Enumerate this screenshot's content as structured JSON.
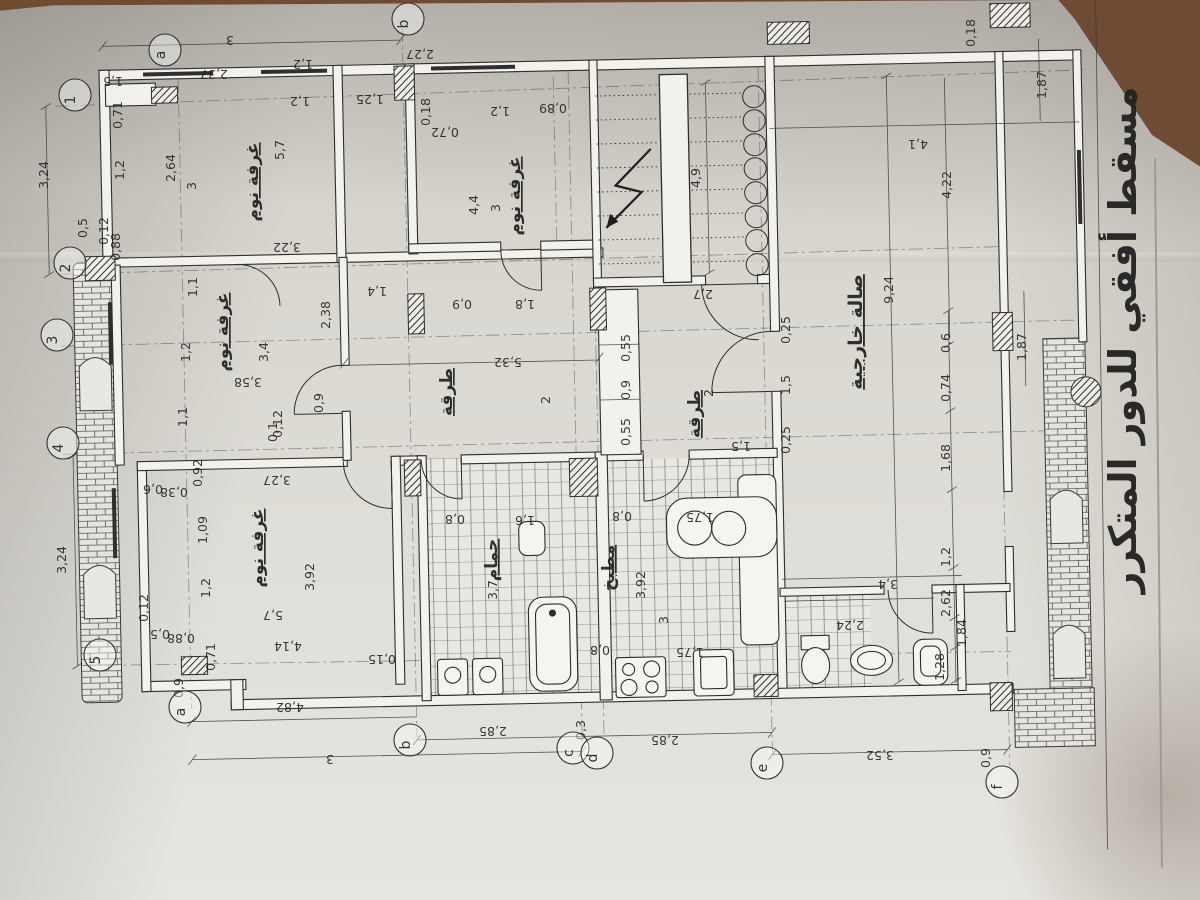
{
  "photo": {
    "background_color": "#6f4b34",
    "paper_color": "#d8d5cf",
    "ink_color": "#2e2e2e"
  },
  "title": {
    "text": "مسقط أفقي للدور المتكرر"
  },
  "plan": {
    "room_labels": [
      {
        "text": "غرفة نوم",
        "x": 258,
        "y": 182,
        "r": -90
      },
      {
        "text": "غرفة نوم",
        "x": 520,
        "y": 196,
        "r": -90
      },
      {
        "text": "غرفة نوم",
        "x": 228,
        "y": 332,
        "r": -90
      },
      {
        "text": "غرفة نوم",
        "x": 263,
        "y": 548,
        "r": -90
      },
      {
        "text": "طرقة",
        "x": 452,
        "y": 392,
        "r": -90
      },
      {
        "text": "طرقة",
        "x": 700,
        "y": 414,
        "r": -90
      },
      {
        "text": "صالة خارجية",
        "x": 862,
        "y": 332,
        "r": -90,
        "big": true
      },
      {
        "text": "حمام",
        "x": 497,
        "y": 560,
        "r": -90,
        "small": true
      },
      {
        "text": "مطبخ",
        "x": 614,
        "y": 568,
        "r": -90,
        "small": true
      }
    ],
    "dimension_labels": [
      {
        "t": "3",
        "x": 230,
        "y": 36,
        "r": 180
      },
      {
        "t": "1,5",
        "x": 113,
        "y": 77,
        "r": 180
      },
      {
        "t": "2,37",
        "x": 214,
        "y": 70,
        "r": 180
      },
      {
        "t": "1,2",
        "x": 303,
        "y": 60,
        "r": 180
      },
      {
        "t": "1,2",
        "x": 300,
        "y": 97,
        "r": 180
      },
      {
        "t": "1,25",
        "x": 370,
        "y": 95,
        "r": 180
      },
      {
        "t": "2,27",
        "x": 420,
        "y": 50,
        "r": 180
      },
      {
        "t": "0,18",
        "x": 430,
        "y": 112,
        "r": -90
      },
      {
        "t": "1,2",
        "x": 500,
        "y": 107,
        "r": 180
      },
      {
        "t": "0,89",
        "x": 553,
        "y": 104,
        "r": 180
      },
      {
        "t": "0,72",
        "x": 445,
        "y": 128,
        "r": 180
      },
      {
        "t": "0,18",
        "x": 975,
        "y": 33,
        "r": -90
      },
      {
        "t": "1,87",
        "x": 1046,
        "y": 85,
        "r": -90
      },
      {
        "t": "4,1",
        "x": 918,
        "y": 140,
        "r": 180
      },
      {
        "t": "4,22",
        "x": 951,
        "y": 185,
        "r": -90
      },
      {
        "t": "4,9",
        "x": 700,
        "y": 178,
        "r": -90
      },
      {
        "t": "2,7",
        "x": 703,
        "y": 290,
        "r": 180
      },
      {
        "t": "9,24",
        "x": 893,
        "y": 290,
        "r": -90
      },
      {
        "t": "2,64",
        "x": 175,
        "y": 168,
        "r": -90
      },
      {
        "t": "3",
        "x": 196,
        "y": 186,
        "r": -90
      },
      {
        "t": "5,7",
        "x": 284,
        "y": 150,
        "r": -90
      },
      {
        "t": "3,22",
        "x": 287,
        "y": 243,
        "r": 180
      },
      {
        "t": "4,4",
        "x": 478,
        "y": 205,
        "r": -90
      },
      {
        "t": "3",
        "x": 500,
        "y": 208,
        "r": -90
      },
      {
        "t": "1,8",
        "x": 525,
        "y": 300,
        "r": 180
      },
      {
        "t": "0,9",
        "x": 462,
        "y": 300,
        "r": 180
      },
      {
        "t": "1,4",
        "x": 377,
        "y": 287,
        "r": 180
      },
      {
        "t": "2,38",
        "x": 330,
        "y": 315,
        "r": -90
      },
      {
        "t": "3,4",
        "x": 268,
        "y": 352,
        "r": -90
      },
      {
        "t": "3,58",
        "x": 248,
        "y": 378,
        "r": 180
      },
      {
        "t": "1,1",
        "x": 197,
        "y": 287,
        "r": -90
      },
      {
        "t": "1,2",
        "x": 190,
        "y": 352,
        "r": -90
      },
      {
        "t": "1,1",
        "x": 187,
        "y": 417,
        "r": -90
      },
      {
        "t": "0,12",
        "x": 282,
        "y": 424,
        "r": -90
      },
      {
        "t": "0,9",
        "x": 323,
        "y": 403,
        "r": -90
      },
      {
        "t": "5,32",
        "x": 508,
        "y": 358,
        "r": 180
      },
      {
        "t": "2",
        "x": 550,
        "y": 400,
        "r": -90
      },
      {
        "t": "0,55",
        "x": 630,
        "y": 348,
        "r": -90
      },
      {
        "t": "0,9",
        "x": 630,
        "y": 390,
        "r": -90
      },
      {
        "t": "0,55",
        "x": 630,
        "y": 432,
        "r": -90
      },
      {
        "t": "2",
        "x": 713,
        "y": 393,
        "r": -90
      },
      {
        "t": "1,5",
        "x": 741,
        "y": 442,
        "r": 180
      },
      {
        "t": "0,25",
        "x": 790,
        "y": 330,
        "r": -90
      },
      {
        "t": "1,5",
        "x": 790,
        "y": 385,
        "r": -90
      },
      {
        "t": "0,25",
        "x": 790,
        "y": 440,
        "r": -90
      },
      {
        "t": "0,6",
        "x": 950,
        "y": 343,
        "r": -90
      },
      {
        "t": "0,74",
        "x": 950,
        "y": 388,
        "r": -90
      },
      {
        "t": "1,68",
        "x": 950,
        "y": 458,
        "r": -90
      },
      {
        "t": "1,87",
        "x": 1026,
        "y": 347,
        "r": -90
      },
      {
        "t": "1,2",
        "x": 950,
        "y": 557,
        "r": -90
      },
      {
        "t": "2,62",
        "x": 950,
        "y": 603,
        "r": -90
      },
      {
        "t": "1,84",
        "x": 966,
        "y": 633,
        "r": -90
      },
      {
        "t": "1,28",
        "x": 944,
        "y": 667,
        "r": -90
      },
      {
        "t": "3,24",
        "x": 48,
        "y": 175,
        "r": -90
      },
      {
        "t": "3,24",
        "x": 66,
        "y": 560,
        "r": -90
      },
      {
        "t": "0,5",
        "x": 87,
        "y": 228,
        "r": -90
      },
      {
        "t": "0,12",
        "x": 108,
        "y": 231,
        "r": -90
      },
      {
        "t": "0,88",
        "x": 120,
        "y": 247,
        "r": -90
      },
      {
        "t": "0,71",
        "x": 122,
        "y": 115,
        "r": -90
      },
      {
        "t": "1,2",
        "x": 124,
        "y": 170,
        "r": -90
      },
      {
        "t": "0,92",
        "x": 202,
        "y": 473,
        "r": -90
      },
      {
        "t": "1,09",
        "x": 207,
        "y": 530,
        "r": -90
      },
      {
        "t": "1,2",
        "x": 210,
        "y": 588,
        "r": -90
      },
      {
        "t": "0,6",
        "x": 153,
        "y": 485,
        "r": 180
      },
      {
        "t": "0,38",
        "x": 174,
        "y": 488,
        "r": 180
      },
      {
        "t": "0,12",
        "x": 148,
        "y": 608,
        "r": -90
      },
      {
        "t": "0,5",
        "x": 160,
        "y": 630,
        "r": 180
      },
      {
        "t": "0,88",
        "x": 181,
        "y": 634,
        "r": 180
      },
      {
        "t": "0,71",
        "x": 215,
        "y": 657,
        "r": -90
      },
      {
        "t": "0,1",
        "x": 277,
        "y": 432,
        "r": -90
      },
      {
        "t": "3,27",
        "x": 277,
        "y": 476,
        "r": 180
      },
      {
        "t": "3,92",
        "x": 314,
        "y": 577,
        "r": -90
      },
      {
        "t": "5,7",
        "x": 273,
        "y": 611,
        "r": 180
      },
      {
        "t": "4,14",
        "x": 288,
        "y": 642,
        "r": 180
      },
      {
        "t": "0,8",
        "x": 455,
        "y": 515,
        "r": 180
      },
      {
        "t": "1,6",
        "x": 525,
        "y": 516,
        "r": 180
      },
      {
        "t": "3,7",
        "x": 497,
        "y": 590,
        "r": -90
      },
      {
        "t": "3,92",
        "x": 645,
        "y": 585,
        "r": -90
      },
      {
        "t": "3",
        "x": 668,
        "y": 620,
        "r": -90
      },
      {
        "t": "1,75",
        "x": 700,
        "y": 513,
        "r": 180
      },
      {
        "t": "0,8",
        "x": 622,
        "y": 512,
        "r": 180
      },
      {
        "t": "1,75",
        "x": 690,
        "y": 648,
        "r": 180
      },
      {
        "t": "0,8",
        "x": 600,
        "y": 646,
        "r": 180
      },
      {
        "t": "3,4",
        "x": 888,
        "y": 580,
        "r": 180
      },
      {
        "t": "2,24",
        "x": 850,
        "y": 621,
        "r": 180
      },
      {
        "t": "3,52",
        "x": 880,
        "y": 751,
        "r": 180
      },
      {
        "t": "0,9",
        "x": 990,
        "y": 758,
        "r": -90
      },
      {
        "t": "0,9",
        "x": 183,
        "y": 688,
        "r": -90
      },
      {
        "t": "4,82",
        "x": 290,
        "y": 703,
        "r": 180
      },
      {
        "t": "3",
        "x": 330,
        "y": 755,
        "r": 180
      },
      {
        "t": "2,85",
        "x": 493,
        "y": 727,
        "r": 180
      },
      {
        "t": "0,3",
        "x": 585,
        "y": 730,
        "r": -90
      },
      {
        "t": "2,85",
        "x": 665,
        "y": 736,
        "r": 180
      },
      {
        "t": "0,15",
        "x": 382,
        "y": 655,
        "r": 180
      }
    ],
    "grid_bubbles": [
      {
        "label": "1",
        "x": 75,
        "y": 95
      },
      {
        "label": "2",
        "x": 70,
        "y": 263
      },
      {
        "label": "3",
        "x": 57,
        "y": 335
      },
      {
        "label": "4",
        "x": 63,
        "y": 443
      },
      {
        "label": "5",
        "x": 100,
        "y": 655
      },
      {
        "label": "a",
        "x": 185,
        "y": 707
      },
      {
        "label": "b",
        "x": 410,
        "y": 740
      },
      {
        "label": "c",
        "x": 573,
        "y": 748
      },
      {
        "label": "d",
        "x": 597,
        "y": 753
      },
      {
        "label": "e",
        "x": 767,
        "y": 763
      },
      {
        "label": "f",
        "x": 1002,
        "y": 782
      },
      {
        "label": "a",
        "x": 165,
        "y": 50
      },
      {
        "label": "b",
        "x": 408,
        "y": 19
      }
    ]
  }
}
